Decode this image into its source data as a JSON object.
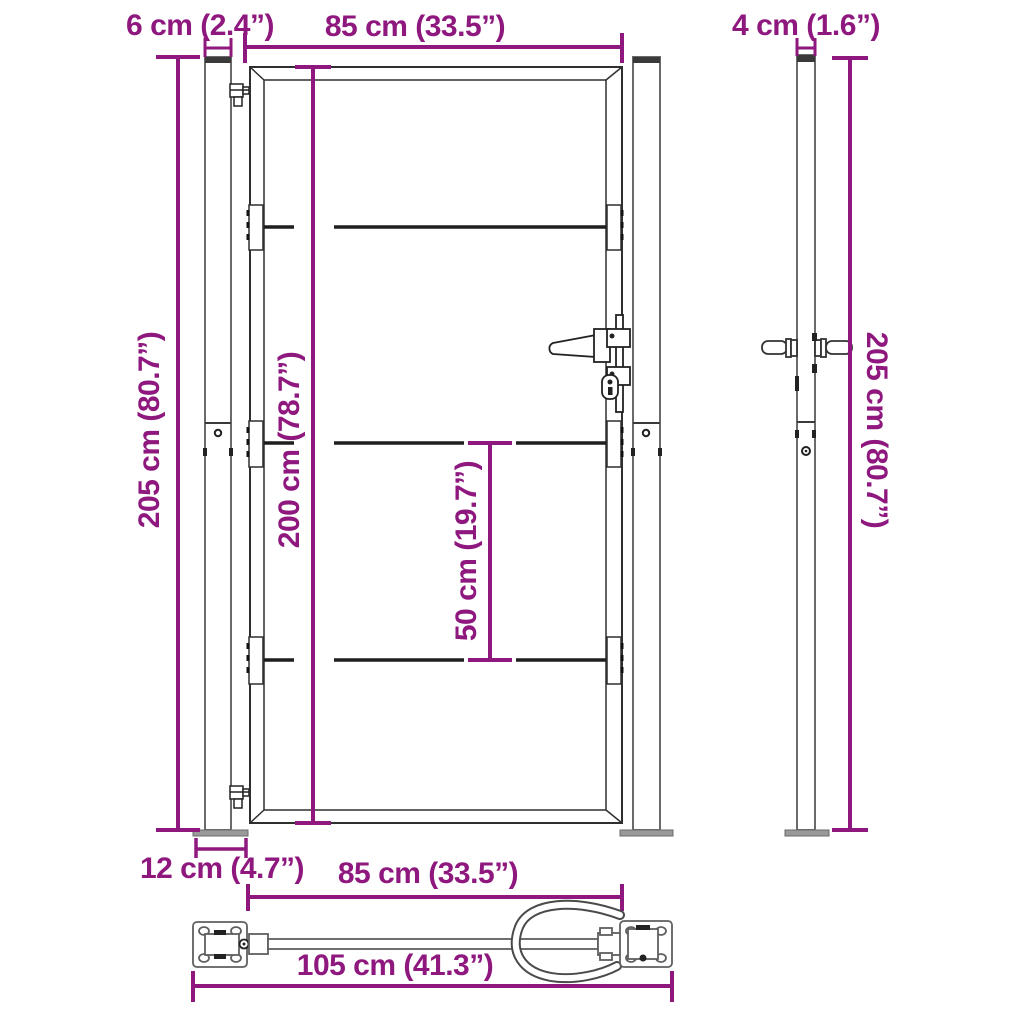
{
  "diagram_title": "Garden gate with posts - dimension diagram",
  "colors": {
    "dimension_accent": "#8E187E",
    "gate_line": "#2f2f2f",
    "post_line": "#6a6a6a",
    "base_plate_fill": "#9a9a9a"
  },
  "front_view": {
    "post_width_label": "6 cm (2.4”)",
    "gate_width_label": "85 cm (33.5”)",
    "total_height_label": "205 cm (80.7”)",
    "gate_height_label": "200 cm (78.7”)",
    "panel_spacing_label": "50 cm (19.7”)"
  },
  "side_view": {
    "post_depth_label": "4 cm (1.6”)",
    "post_height_label": "205 cm (80.7”)"
  },
  "bottom_view": {
    "base_plate_label": "12 cm (4.7”)",
    "gate_width_label": "85 cm (33.5”)",
    "total_width_label": "105 cm (41.3”)"
  }
}
